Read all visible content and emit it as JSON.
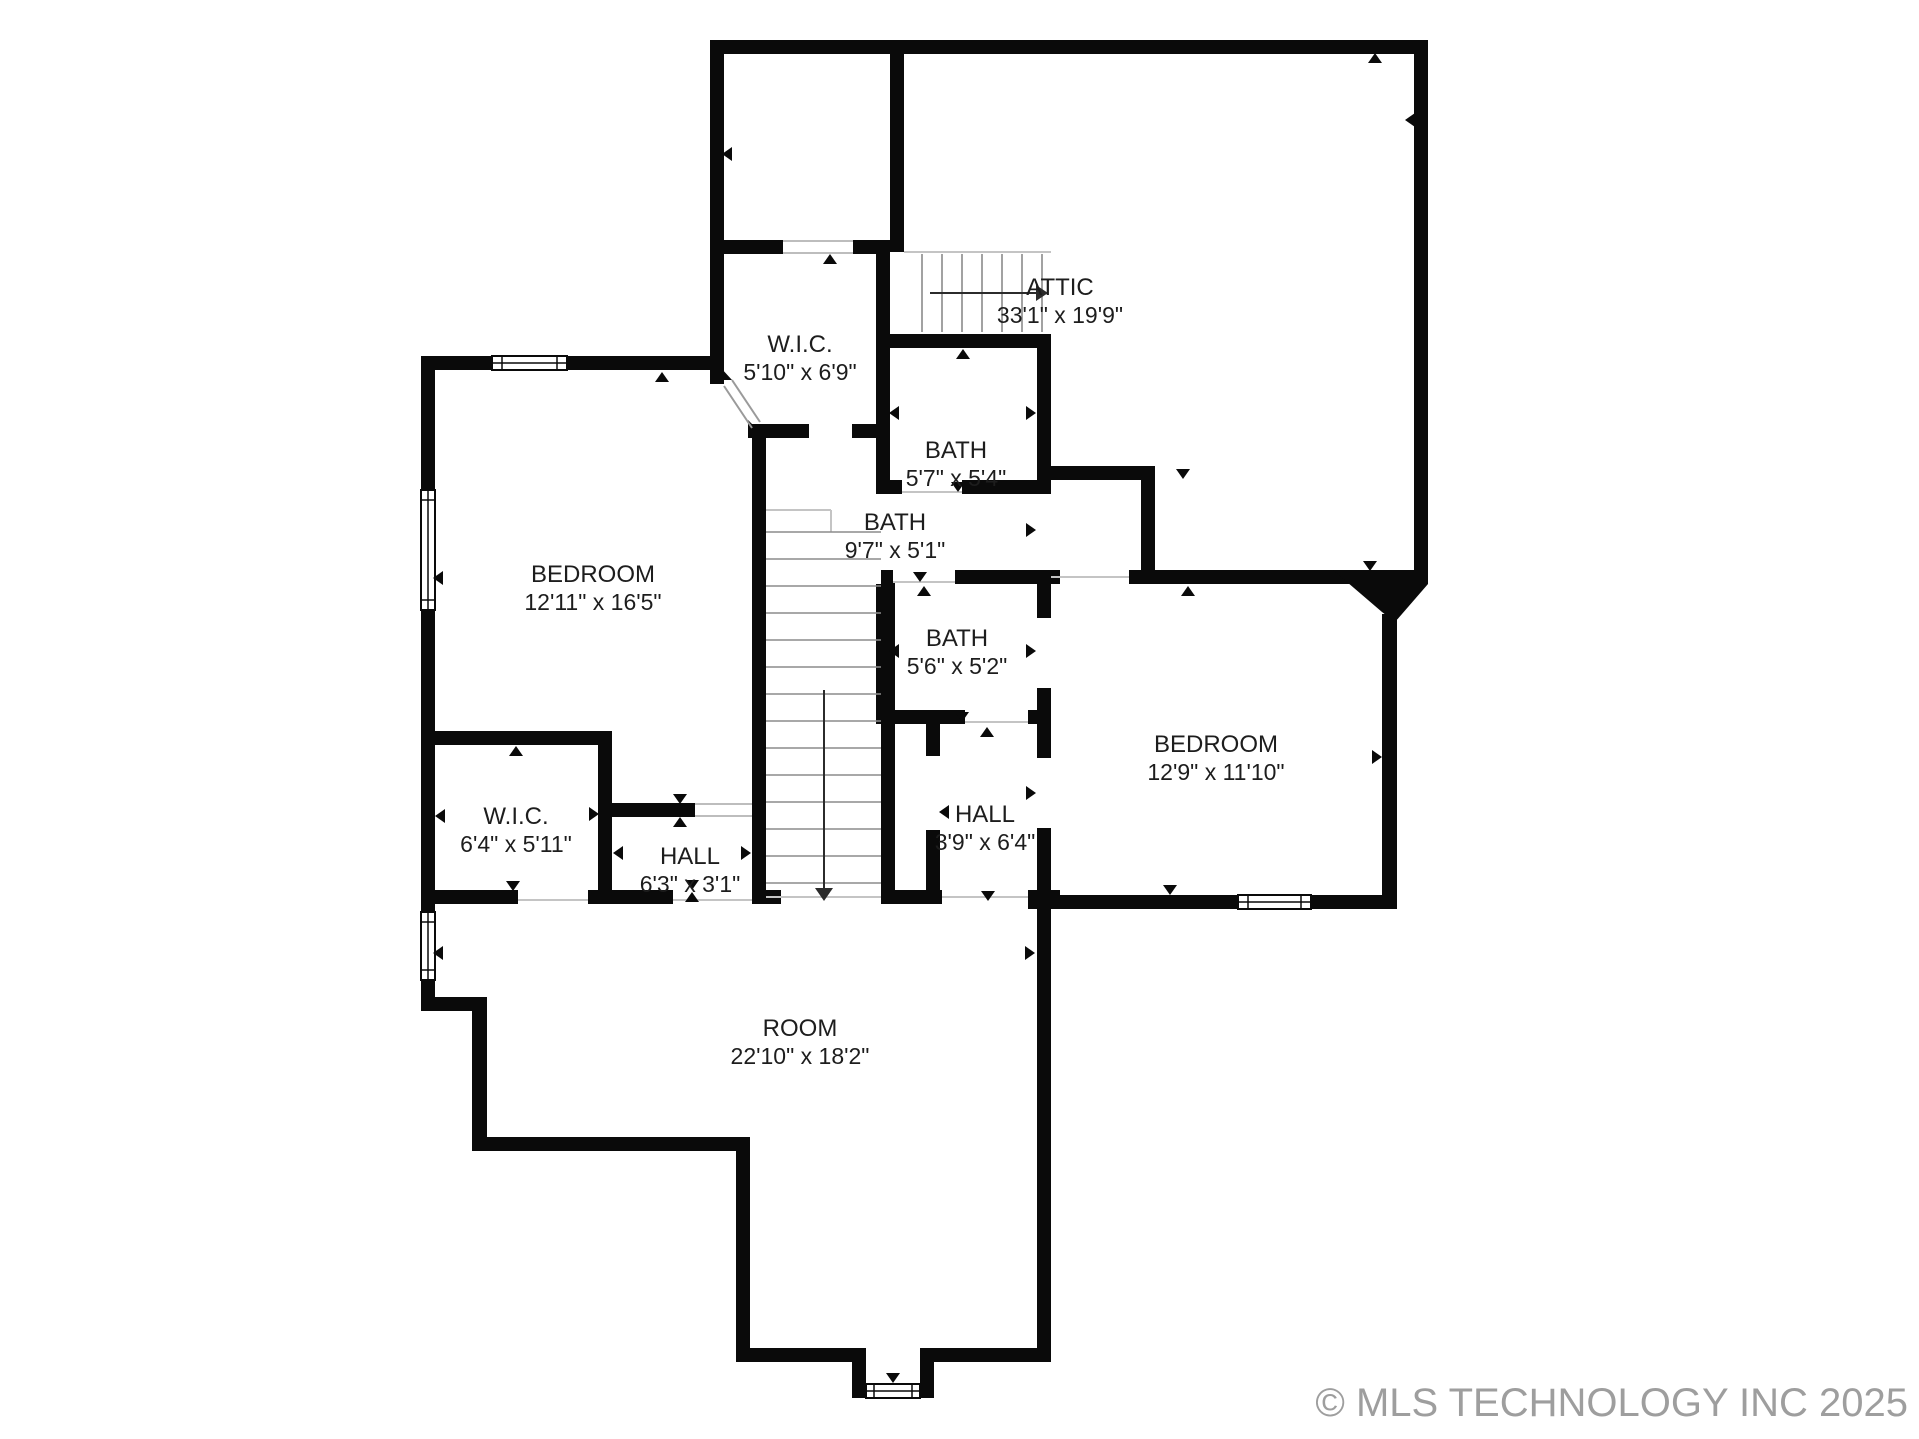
{
  "rooms": [
    {
      "id": "attic",
      "name": "ATTIC",
      "dims": "33'1\" x 19'9\""
    },
    {
      "id": "wic_upper",
      "name": "W.I.C.",
      "dims": "5'10\" x 6'9\""
    },
    {
      "id": "bath_small",
      "name": "BATH",
      "dims": "5'7\" x 5'4\""
    },
    {
      "id": "bath_hall",
      "name": "BATH",
      "dims": "9'7\" x 5'1\""
    },
    {
      "id": "bedroom_left",
      "name": "BEDROOM",
      "dims": "12'11\" x 16'5\""
    },
    {
      "id": "bath_mid",
      "name": "BATH",
      "dims": "5'6\" x 5'2\""
    },
    {
      "id": "bedroom_right",
      "name": "BEDROOM",
      "dims": "12'9\" x 11'10\""
    },
    {
      "id": "wic_lower",
      "name": "W.I.C.",
      "dims": "6'4\" x 5'11\""
    },
    {
      "id": "hall_left",
      "name": "HALL",
      "dims": "6'3\" x 3'1\""
    },
    {
      "id": "hall_right",
      "name": "HALL",
      "dims": "3'9\" x 6'4\""
    },
    {
      "id": "room",
      "name": "ROOM",
      "dims": "22'10\" x 18'2\""
    }
  ],
  "copyright": "© MLS TECHNOLOGY INC 2025",
  "colors": {
    "wall": "#0a0a0a",
    "label_text": "#1d1d1d",
    "copyright_text": "#9e9e9e",
    "open_boundary": "#c4c4c4",
    "stair_tread": "#8b8b8b"
  }
}
